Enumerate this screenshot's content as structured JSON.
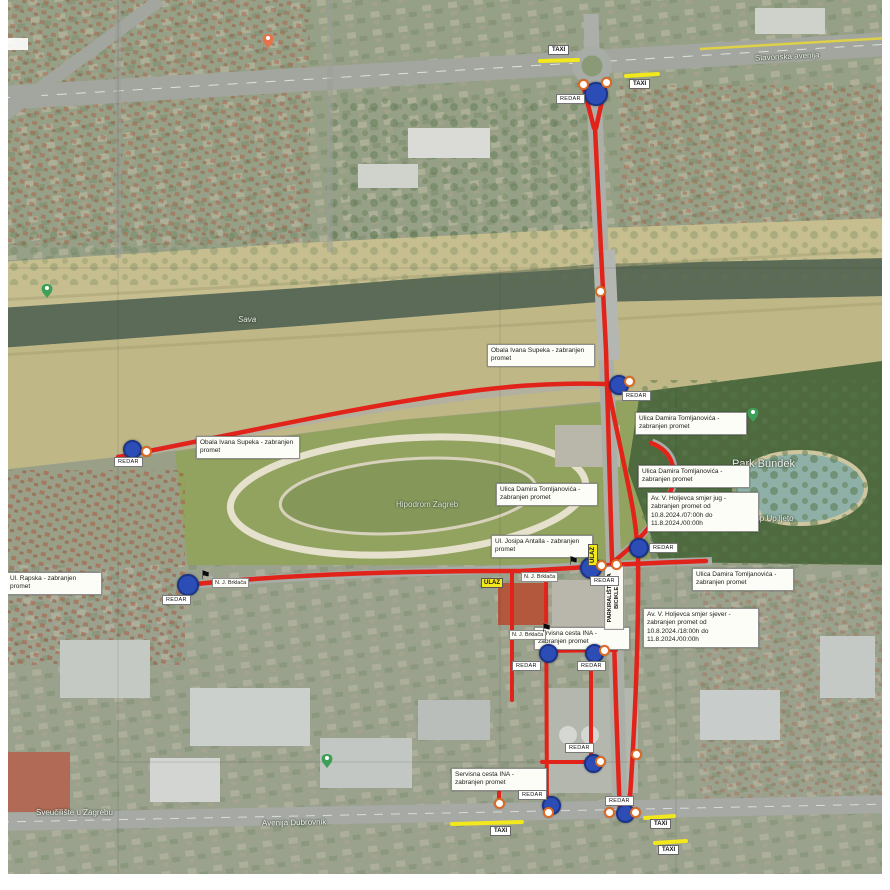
{
  "badges": {
    "redar": "REDAR",
    "taxi": "TAXI",
    "ulaz": "ULAZ"
  },
  "labels": {
    "street": "N. J. Brklača",
    "bike_parking": "PARKIRALIŠTE ZA BICIKLE"
  },
  "annotations": [
    {
      "text": "Obala Ivana Supeka - zabranjen promet"
    },
    {
      "text": "Obala Ivana Supeka - zabranjen promet"
    },
    {
      "text": "Ulica Damira Tomljanovića - zabranjen promet"
    },
    {
      "text": "Ulica Damira Tomljanovića - zabranjen promet"
    },
    {
      "text": "Ulica Damira Tomljanovića - zabranjen promet"
    },
    {
      "text": "Ul. Josipa Antalla - zabranjen promet"
    },
    {
      "text": "Av. V. Holjevca smjer jug - zabranjen promet od 10.8.2024./07:00h do 11.8.2024./00:00h"
    },
    {
      "text": "Av. V. Holjevca smjer sjever - zabranjen promet od 10.8.2024./18:00h do 11.8.2024./00:00h"
    },
    {
      "text": "Servisna cesta INA - zabranjen promet"
    },
    {
      "text": "Servisna cesta INA - zabranjen promet"
    },
    {
      "text": "Ulica Damira Tomljanovića - zabranjen promet"
    },
    {
      "text": "Ul. Rapska - zabranjen promet"
    }
  ],
  "map_labels": {
    "slavonska": "Slavonska avenija",
    "sava": "Sava",
    "bundek": "Park Bundek",
    "popup": "Pop Up ljeto",
    "hipodrom": "Hipodrom Zagreb",
    "sveuciliste": "Sveučilište u Zagrebu",
    "dubrovnik": "Avenija Dubrovnik"
  },
  "colors": {
    "closed_route": "#e2231a",
    "taxi_zone": "#f2e81c",
    "steward_dot": "#2c4db5",
    "checkpoint_ring": "#dd6b24"
  }
}
